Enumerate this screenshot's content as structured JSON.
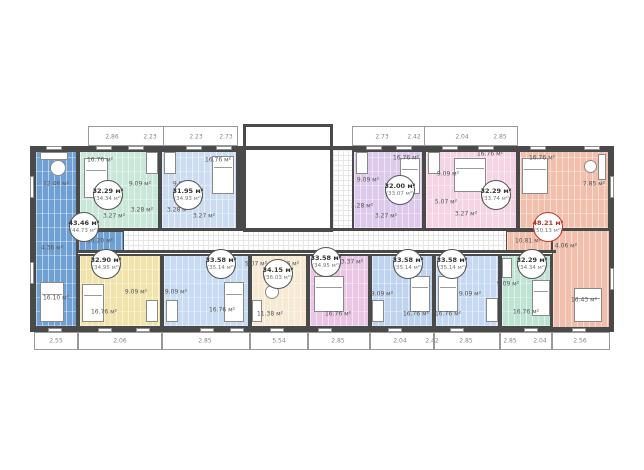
{
  "palette": {
    "wall": "#4a4a4a",
    "highlight_circle": "#c0392b"
  },
  "area_unit": "м²",
  "units": [
    {
      "id": "t1",
      "area": "43.46 м²",
      "total": "(44.73 м²)",
      "color": "#6fa0d4",
      "highlighted": false,
      "rooms": [
        "12.46 м²",
        "4.36 м²",
        "10.20 м²",
        "16.10 м²"
      ]
    },
    {
      "id": "t2",
      "area": "32.29 м²",
      "total": "(34.34 м²)",
      "color": "#c9e8d9",
      "highlighted": false,
      "rooms": [
        "16.76 м²",
        "9.09 м²",
        "3.27 м²",
        "3.28 м²"
      ]
    },
    {
      "id": "t3",
      "area": "31.95 м²",
      "total": "(34.93 м²)",
      "color": "#ccddf1",
      "highlighted": false,
      "rooms": [
        "16.76 м²",
        "9.09 м²",
        "3.27 м²",
        "3.28 м²"
      ]
    },
    {
      "id": "t4",
      "area": "32.00 м²",
      "total": "(33.07 м²)",
      "color": "#dcc9ec",
      "highlighted": false,
      "rooms": [
        "16.76 м²",
        "9.09 м²",
        "3.27 м²",
        "3.28 м²"
      ]
    },
    {
      "id": "t5",
      "area": "32.29 м²",
      "total": "(33.74 м²)",
      "color": "#f4d4e5",
      "highlighted": false,
      "rooms": [
        "16.76 м²",
        "9.09 м²",
        "5.07 м²",
        "3.27 м²"
      ]
    },
    {
      "id": "t6",
      "area": "48.21 м²",
      "total": "(50.13 м²)",
      "color": "#f1bfab",
      "highlighted": true,
      "rooms": [
        "16.76 м²",
        "7.85 м²",
        "10.81 м²",
        "4.06 м²",
        "16.43 м²"
      ]
    },
    {
      "id": "b1",
      "area": "32.90 м²",
      "total": "(34.95 м²)",
      "color": "#f1e3ac",
      "highlighted": false,
      "rooms": [
        "16.76 м²",
        "9.09 м²"
      ]
    },
    {
      "id": "b2",
      "area": "33.58 м²",
      "total": "(35.14 м²)",
      "color": "#c7dbf2",
      "highlighted": false,
      "rooms": [
        "16.76 м²",
        "9.09 м²"
      ]
    },
    {
      "id": "b3",
      "area": "34.15 м²",
      "total": "(36.03 м²)",
      "color": "#f6ead4",
      "highlighted": false,
      "rooms": [
        "11.38 м²",
        "4.86 м²",
        "5.07 м²"
      ]
    },
    {
      "id": "b4",
      "area": "33.58 м²",
      "total": "(34.95 м²)",
      "color": "#e9c7e4",
      "highlighted": false,
      "rooms": [
        "16.76 м²",
        "3.37 м²"
      ]
    },
    {
      "id": "b5",
      "area": "33.58 м²",
      "total": "(35.14 м²)",
      "color": "#bed3ee",
      "highlighted": false,
      "rooms": [
        "16.76 м²",
        "9.09 м²"
      ]
    },
    {
      "id": "b6",
      "area": "33.58 м²",
      "total": "(35.14 м²)",
      "color": "#c6d9f2",
      "highlighted": false,
      "rooms": [
        "16.76 м²",
        "9.09 м²"
      ]
    },
    {
      "id": "b7",
      "area": "32.29 м²",
      "total": "(34.34 м²)",
      "color": "#bfe4d4",
      "highlighted": false,
      "rooms": [
        "16.76 м²",
        "9.09 м²"
      ]
    }
  ],
  "dims_top": [
    "2.86",
    "2.23",
    "2.23",
    "2.73",
    "2.73",
    "2.42",
    "2.04",
    "2.85"
  ],
  "dims_bottom": [
    "2.55",
    "2.06",
    "2.85",
    "5.54",
    "2.85",
    "2.04",
    "2.42",
    "2.85",
    "2.85",
    "2.04",
    "2.56"
  ]
}
